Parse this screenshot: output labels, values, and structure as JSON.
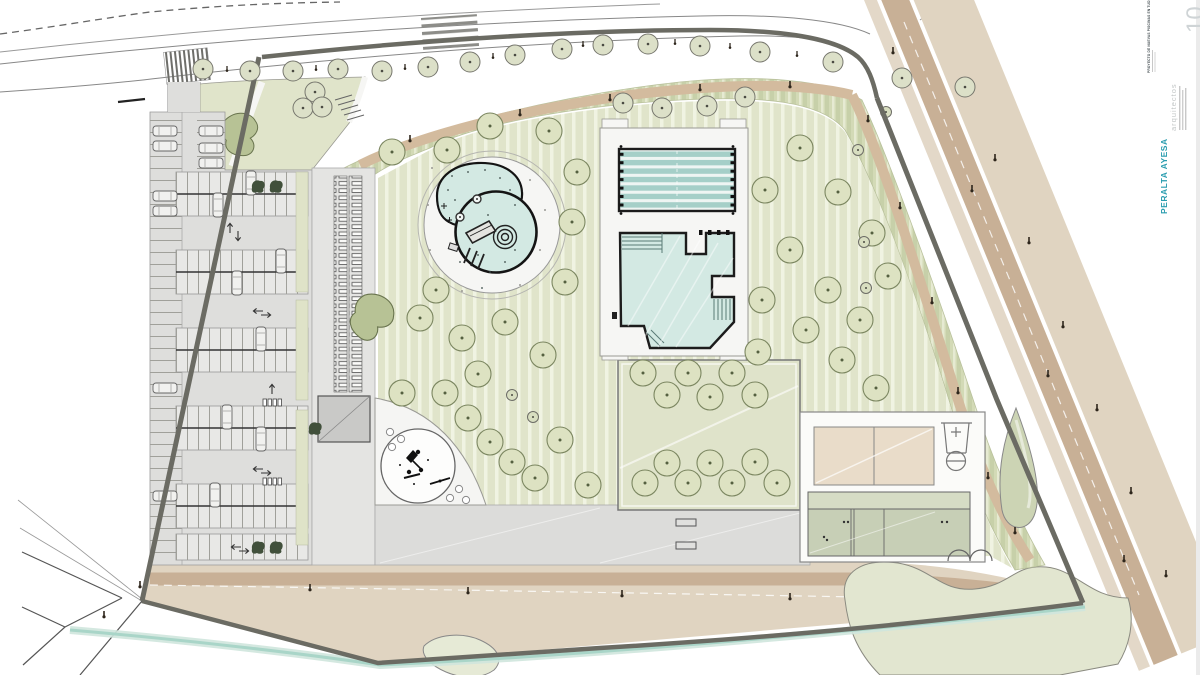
{
  "sheet": {
    "firm_name": "PERALTA AYESA",
    "firm_subtitle": "arquitectos",
    "project_title": "PROYECTO DE NUEVAS PISCINAS EN TUDELA, NAV",
    "sheet_number": "10"
  },
  "colors": {
    "accent_teal": "#2a9daf",
    "muted_gray": "#c3c7c7",
    "title_dark": "#3e484c",
    "sheet_number_gray": "#cfd4d6",
    "lawn_green": "#e0e4ca",
    "water_teal": "#d3e9e3",
    "lane_teal": "#a5cfc8",
    "road_tan": "#c8b096",
    "light_tan": "#e0d4c1",
    "boundary_gray": "#6b6b63",
    "stream_teal": "#a9d5c8",
    "asphalt_gray": "#dededc",
    "court_beige": "#e9dcc9"
  }
}
